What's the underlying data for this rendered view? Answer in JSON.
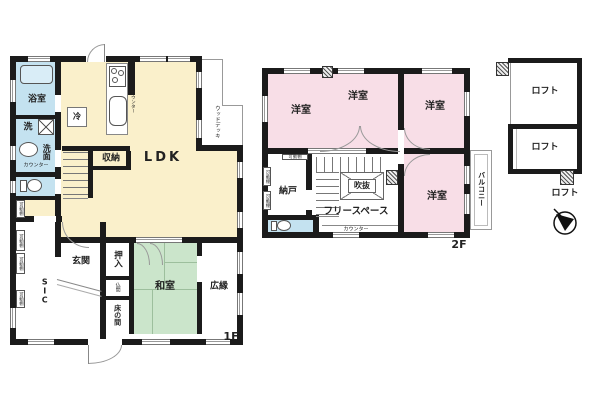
{
  "title": "floor-plan",
  "colors": {
    "ldk_fill": "#faf0cb",
    "wet_area_fill": "#c4e2f0",
    "tatami_fill": "#cbe5cb",
    "bedroom_fill": "#f8dee7",
    "wall": "#1b1b1b"
  },
  "floor1": {
    "label": "1F",
    "ldk": "LDK",
    "bath": "浴室",
    "laundry": "洗",
    "vanity": "洗面",
    "counter_label": "カウンター",
    "fridge": "冷",
    "storage": "収納",
    "wood_deck": "ウッドデッキ",
    "entrance": "玄関",
    "sic": "SIC",
    "oshiire": "押入",
    "butsuma": "仏間",
    "tokonoma": "床の間",
    "washitsu": "和室",
    "hiroen": "広縁",
    "shelf": "可動棚"
  },
  "floor2": {
    "label": "2F",
    "bedroom": "洋室",
    "nando": "納戸",
    "void_label": "吹抜",
    "free_space": "フリースペース",
    "counter_label": "カウンター",
    "balcony": "バルコニー",
    "shelf": "可動棚"
  },
  "loft": {
    "label": "ロフト"
  }
}
